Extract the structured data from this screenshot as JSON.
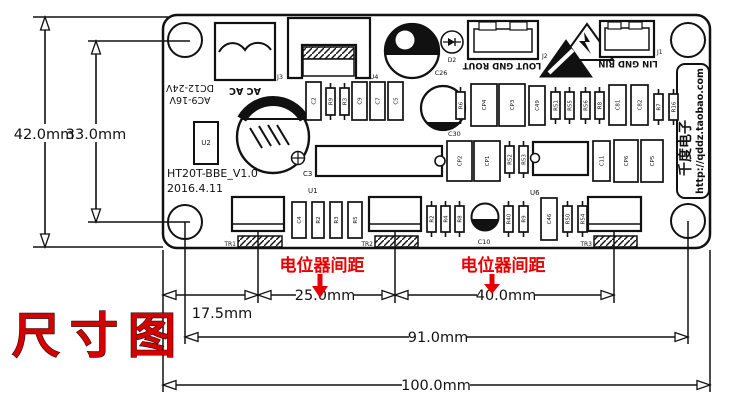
{
  "title_stamp": "尺寸图",
  "colors": {
    "red": "#e60000",
    "ink": "#111111",
    "board_bg": "#ffffff"
  },
  "annotations": {
    "pot_spacing_1": "电位器间距",
    "pot_spacing_2": "电位器间距"
  },
  "dimensions": {
    "width_total": "100.0mm",
    "hole_span": "91.0mm",
    "pot1_offset": "17.5mm",
    "pot_gap_1_2": "25.0mm",
    "pot_gap_2_3": "40.0mm",
    "height_total": "42.0mm",
    "hole_height": "33.0mm"
  },
  "board": {
    "model": "HT20T-BBE_V1.0",
    "date": "2016.4.11",
    "brand": "千度电子",
    "brand_url": "http://qddz.taobao.com",
    "power_label_line1": "AC9-16V",
    "power_label_line2": "DC12-24V",
    "ac_label": "AC   AC",
    "output_label": "LOUT GND ROUT",
    "input_label": "LIN GND RIN",
    "labels": {
      "j3": "J3",
      "u4": "U4",
      "c26": "C26",
      "d2": "D2",
      "j2": "J2",
      "j1": "J1",
      "u2": "U2",
      "c3": "C3",
      "u1": "U1",
      "u6": "U6",
      "c30": "C30",
      "c10": "C10",
      "tr1": "TR1",
      "tr2": "TR2",
      "tr3": "TR3"
    }
  },
  "components": [
    {
      "x": 306,
      "y": 82,
      "w": 15,
      "h": 38,
      "label": "C2",
      "kind": "cap"
    },
    {
      "x": 326,
      "y": 88,
      "w": 9,
      "h": 27,
      "label": "R9",
      "kind": "res"
    },
    {
      "x": 340,
      "y": 88,
      "w": 9,
      "h": 27,
      "label": "R3",
      "kind": "res"
    },
    {
      "x": 352,
      "y": 82,
      "w": 15,
      "h": 38,
      "label": "C9",
      "kind": "cap"
    },
    {
      "x": 370,
      "y": 82,
      "w": 15,
      "h": 38,
      "label": "C7",
      "kind": "cap"
    },
    {
      "x": 388,
      "y": 82,
      "w": 15,
      "h": 38,
      "label": "C5",
      "kind": "cap"
    },
    {
      "x": 456,
      "y": 92,
      "w": 9,
      "h": 27,
      "label": "R6",
      "kind": "res"
    },
    {
      "x": 471,
      "y": 84,
      "w": 26,
      "h": 42,
      "label": "CP4",
      "kind": "cap"
    },
    {
      "x": 499,
      "y": 84,
      "w": 26,
      "h": 42,
      "label": "CP3",
      "kind": "cap"
    },
    {
      "x": 529,
      "y": 86,
      "w": 16,
      "h": 39,
      "label": "C49",
      "kind": "cap"
    },
    {
      "x": 551,
      "y": 92,
      "w": 9,
      "h": 27,
      "label": "R51",
      "kind": "res"
    },
    {
      "x": 565,
      "y": 92,
      "w": 9,
      "h": 27,
      "label": "R55",
      "kind": "res"
    },
    {
      "x": 581,
      "y": 92,
      "w": 9,
      "h": 27,
      "label": "R56",
      "kind": "res"
    },
    {
      "x": 595,
      "y": 92,
      "w": 9,
      "h": 27,
      "label": "R8",
      "kind": "res"
    },
    {
      "x": 609,
      "y": 85,
      "w": 17,
      "h": 40,
      "label": "C81",
      "kind": "cap"
    },
    {
      "x": 631,
      "y": 85,
      "w": 17,
      "h": 40,
      "label": "C82",
      "kind": "cap"
    },
    {
      "x": 654,
      "y": 94,
      "w": 9,
      "h": 26,
      "label": "R7",
      "kind": "res"
    },
    {
      "x": 669,
      "y": 94,
      "w": 9,
      "h": 26,
      "label": "R16",
      "kind": "res"
    },
    {
      "x": 447,
      "y": 141,
      "w": 25,
      "h": 40,
      "label": "CP2",
      "kind": "cap"
    },
    {
      "x": 474,
      "y": 141,
      "w": 26,
      "h": 40,
      "label": "CP1",
      "kind": "cap"
    },
    {
      "x": 505,
      "y": 146,
      "w": 9,
      "h": 27,
      "label": "R52",
      "kind": "res"
    },
    {
      "x": 519,
      "y": 146,
      "w": 9,
      "h": 27,
      "label": "R53",
      "kind": "res"
    },
    {
      "x": 593,
      "y": 141,
      "w": 17,
      "h": 40,
      "label": "C11",
      "kind": "cap"
    },
    {
      "x": 614,
      "y": 140,
      "w": 24,
      "h": 42,
      "label": "CP6",
      "kind": "cap"
    },
    {
      "x": 641,
      "y": 140,
      "w": 22,
      "h": 42,
      "label": "CP5",
      "kind": "cap"
    },
    {
      "x": 292,
      "y": 202,
      "w": 14,
      "h": 36,
      "label": "C4",
      "kind": "cap"
    },
    {
      "x": 312,
      "y": 202,
      "w": 12,
      "h": 36,
      "label": "R2",
      "kind": "cap"
    },
    {
      "x": 330,
      "y": 202,
      "w": 12,
      "h": 36,
      "label": "R3",
      "kind": "cap"
    },
    {
      "x": 348,
      "y": 202,
      "w": 14,
      "h": 36,
      "label": "R5",
      "kind": "cap"
    },
    {
      "x": 427,
      "y": 206,
      "w": 9,
      "h": 26,
      "label": "R2",
      "kind": "res"
    },
    {
      "x": 441,
      "y": 206,
      "w": 9,
      "h": 26,
      "label": "R4",
      "kind": "res"
    },
    {
      "x": 455,
      "y": 206,
      "w": 9,
      "h": 26,
      "label": "R8",
      "kind": "res"
    },
    {
      "x": 504,
      "y": 206,
      "w": 9,
      "h": 26,
      "label": "R40",
      "kind": "res"
    },
    {
      "x": 519,
      "y": 206,
      "w": 9,
      "h": 26,
      "label": "R9",
      "kind": "res"
    },
    {
      "x": 541,
      "y": 198,
      "w": 16,
      "h": 42,
      "label": "C46",
      "kind": "cap"
    },
    {
      "x": 563,
      "y": 206,
      "w": 9,
      "h": 26,
      "label": "R50",
      "kind": "res"
    },
    {
      "x": 578,
      "y": 206,
      "w": 9,
      "h": 26,
      "label": "R54",
      "kind": "res"
    }
  ]
}
